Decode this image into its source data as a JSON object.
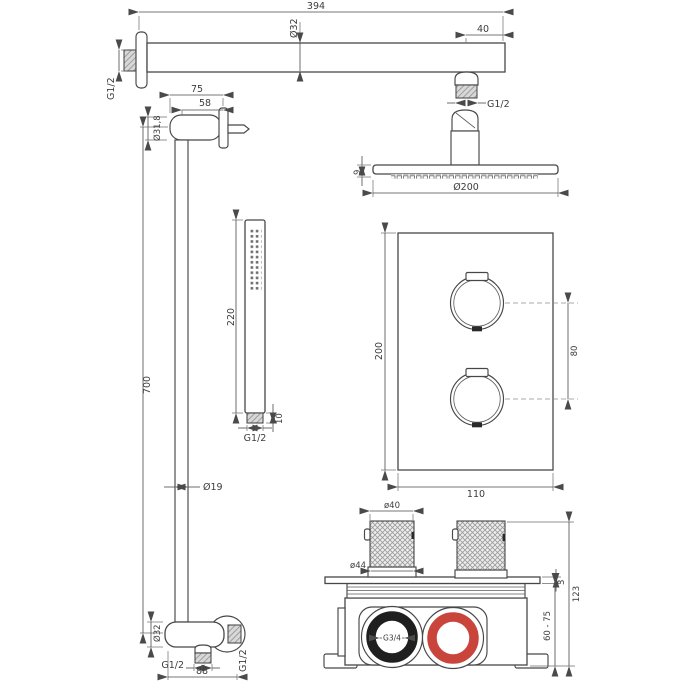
{
  "colors": {
    "line": "#474747",
    "hot_ring_red": "#c9453c",
    "cold_ring_black": "#1f1f1f"
  },
  "components": {
    "shower_arm": {
      "length": "394",
      "diameter": "Ø32",
      "end_offset": "40",
      "wall_thread": "G1/2",
      "outlet_thread": "G1/2"
    },
    "wall_bracket": {
      "projection": "75",
      "inner_projection": "58",
      "diameter": "Ø31,8"
    },
    "slide_rail": {
      "length": "700",
      "diameter": "Ø19"
    },
    "hand_shower": {
      "length": "220",
      "connector_height": "10",
      "thread": "G1/2"
    },
    "shower_head": {
      "thickness": "9",
      "diameter": "Ø200"
    },
    "wall_outlet": {
      "diameter": "Ø32",
      "bottom_thread": "G1/2",
      "side_thread": "G1/2",
      "length": "88"
    },
    "thermostat_plate": {
      "height": "200",
      "width": "110",
      "handle_spacing": "80"
    },
    "valve_box": {
      "handle_diameter": "ø40",
      "handle_base_diameter": "ø44",
      "inlet_label": "G3/4",
      "plate_thickness": "3",
      "total_depth": "123",
      "installation_depth": "60 - 75"
    }
  }
}
